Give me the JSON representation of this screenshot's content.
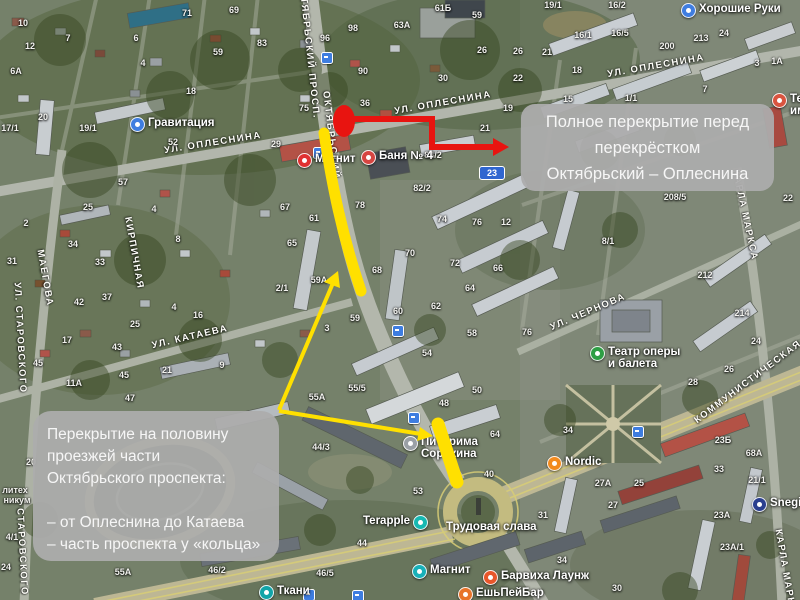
{
  "annotations": {
    "full_closure_note": {
      "lines": [
        "Полное перекрытие перед",
        "перекрёстком",
        "Октябрьский – Оплеснина"
      ]
    },
    "half_closure_note": {
      "lines": [
        "Перекрытие на половину",
        "проезжей части",
        "Октябрьского проспекта:",
        "",
        "– от Оплеснина до Катаева",
        "– часть проспекта у «кольца»"
      ]
    },
    "colors": {
      "marker_red": "#e81410",
      "highlight_yellow": "#ffe000",
      "note_bg": "rgba(172,172,172,0.94)",
      "note_text": "#f6f6f6"
    }
  },
  "map": {
    "street_labels": [
      {
        "text": "Октябрьский просп.",
        "x": 309,
        "y": 50,
        "rot": 84
      },
      {
        "text": "Октябрьский",
        "x": 331,
        "y": 135,
        "rot": 83
      },
      {
        "text": "ул. Оплеснина",
        "x": 213,
        "y": 143,
        "rot": -9
      },
      {
        "text": "ул. Оплеснина",
        "x": 443,
        "y": 103,
        "rot": -10
      },
      {
        "text": "ул. Оплеснина",
        "x": 656,
        "y": 66,
        "rot": -10
      },
      {
        "text": "ул. Катаева",
        "x": 190,
        "y": 337,
        "rot": -13
      },
      {
        "text": "ул. Чернова",
        "x": 588,
        "y": 312,
        "rot": -23
      },
      {
        "text": "Коммунистическая",
        "x": 748,
        "y": 382,
        "rot": -37
      },
      {
        "text": "Карла Маркса",
        "x": 745,
        "y": 215,
        "rot": 78
      },
      {
        "text": "Карла Маркса",
        "x": 786,
        "y": 575,
        "rot": 80
      },
      {
        "text": "ул. Старовского",
        "x": 20,
        "y": 338,
        "rot": 87
      },
      {
        "text": "Старовского",
        "x": 22,
        "y": 552,
        "rot": 87
      },
      {
        "text": "Маегова",
        "x": 45,
        "y": 278,
        "rot": 80
      },
      {
        "text": "Кирпичная",
        "x": 134,
        "y": 253,
        "rot": 80
      }
    ],
    "house_numbers": [
      {
        "n": "10",
        "x": 23,
        "y": 23
      },
      {
        "n": "12",
        "x": 30,
        "y": 46
      },
      {
        "n": "6А",
        "x": 16,
        "y": 71
      },
      {
        "n": "7",
        "x": 68,
        "y": 38
      },
      {
        "n": "6",
        "x": 136,
        "y": 38
      },
      {
        "n": "71",
        "x": 187,
        "y": 13
      },
      {
        "n": "69",
        "x": 234,
        "y": 10
      },
      {
        "n": "83",
        "x": 262,
        "y": 43
      },
      {
        "n": "59",
        "x": 218,
        "y": 52
      },
      {
        "n": "4",
        "x": 143,
        "y": 63
      },
      {
        "n": "18",
        "x": 191,
        "y": 91
      },
      {
        "n": "20",
        "x": 43,
        "y": 117
      },
      {
        "n": "17/1",
        "x": 10,
        "y": 128
      },
      {
        "n": "19/1",
        "x": 88,
        "y": 128
      },
      {
        "n": "52",
        "x": 173,
        "y": 142
      },
      {
        "n": "57",
        "x": 123,
        "y": 182
      },
      {
        "n": "98",
        "x": 353,
        "y": 28
      },
      {
        "n": "96",
        "x": 325,
        "y": 38
      },
      {
        "n": "63А",
        "x": 402,
        "y": 25
      },
      {
        "n": "61Б",
        "x": 443,
        "y": 8
      },
      {
        "n": "59",
        "x": 477,
        "y": 15
      },
      {
        "n": "26",
        "x": 482,
        "y": 50
      },
      {
        "n": "26",
        "x": 518,
        "y": 51
      },
      {
        "n": "90",
        "x": 363,
        "y": 71
      },
      {
        "n": "30",
        "x": 443,
        "y": 78
      },
      {
        "n": "22",
        "x": 518,
        "y": 78
      },
      {
        "n": "36",
        "x": 365,
        "y": 103
      },
      {
        "n": "75",
        "x": 304,
        "y": 108
      },
      {
        "n": "29",
        "x": 276,
        "y": 144
      },
      {
        "n": "19",
        "x": 508,
        "y": 108
      },
      {
        "n": "21",
        "x": 485,
        "y": 128
      },
      {
        "n": "84/2",
        "x": 433,
        "y": 155
      },
      {
        "n": "82/2",
        "x": 422,
        "y": 188
      },
      {
        "n": "19/1",
        "x": 553,
        "y": 5
      },
      {
        "n": "16/2",
        "x": 617,
        "y": 5
      },
      {
        "n": "16/1",
        "x": 583,
        "y": 35
      },
      {
        "n": "16/5",
        "x": 620,
        "y": 33
      },
      {
        "n": "21",
        "x": 547,
        "y": 52
      },
      {
        "n": "18",
        "x": 577,
        "y": 70
      },
      {
        "n": "200",
        "x": 667,
        "y": 46
      },
      {
        "n": "213",
        "x": 701,
        "y": 38
      },
      {
        "n": "24",
        "x": 724,
        "y": 33
      },
      {
        "n": "3",
        "x": 757,
        "y": 63
      },
      {
        "n": "1А",
        "x": 777,
        "y": 61
      },
      {
        "n": "15",
        "x": 568,
        "y": 99
      },
      {
        "n": "1/1",
        "x": 631,
        "y": 98
      },
      {
        "n": "7",
        "x": 705,
        "y": 89
      },
      {
        "n": "208/5",
        "x": 675,
        "y": 197
      },
      {
        "n": "8/1",
        "x": 608,
        "y": 241
      },
      {
        "n": "22",
        "x": 788,
        "y": 198
      },
      {
        "n": "212",
        "x": 705,
        "y": 275
      },
      {
        "n": "214",
        "x": 742,
        "y": 313
      },
      {
        "n": "24",
        "x": 756,
        "y": 341
      },
      {
        "n": "26",
        "x": 729,
        "y": 369
      },
      {
        "n": "28",
        "x": 693,
        "y": 382
      },
      {
        "n": "23Б",
        "x": 723,
        "y": 440
      },
      {
        "n": "34",
        "x": 568,
        "y": 430
      },
      {
        "n": "67",
        "x": 285,
        "y": 207
      },
      {
        "n": "61",
        "x": 314,
        "y": 218
      },
      {
        "n": "65",
        "x": 292,
        "y": 243
      },
      {
        "n": "78",
        "x": 360,
        "y": 205
      },
      {
        "n": "59А",
        "x": 319,
        "y": 280
      },
      {
        "n": "2/1",
        "x": 282,
        "y": 288
      },
      {
        "n": "68",
        "x": 377,
        "y": 270
      },
      {
        "n": "74",
        "x": 442,
        "y": 219
      },
      {
        "n": "76",
        "x": 477,
        "y": 222
      },
      {
        "n": "12",
        "x": 506,
        "y": 222
      },
      {
        "n": "70",
        "x": 410,
        "y": 253
      },
      {
        "n": "72",
        "x": 455,
        "y": 263
      },
      {
        "n": "66",
        "x": 498,
        "y": 268
      },
      {
        "n": "64",
        "x": 470,
        "y": 288
      },
      {
        "n": "62",
        "x": 436,
        "y": 306
      },
      {
        "n": "60",
        "x": 398,
        "y": 311
      },
      {
        "n": "59",
        "x": 355,
        "y": 318
      },
      {
        "n": "3",
        "x": 327,
        "y": 328
      },
      {
        "n": "58",
        "x": 472,
        "y": 333
      },
      {
        "n": "76",
        "x": 527,
        "y": 332
      },
      {
        "n": "54",
        "x": 427,
        "y": 353
      },
      {
        "n": "55/5",
        "x": 357,
        "y": 388
      },
      {
        "n": "55А",
        "x": 317,
        "y": 397
      },
      {
        "n": "44/3",
        "x": 321,
        "y": 447
      },
      {
        "n": "53",
        "x": 418,
        "y": 491
      },
      {
        "n": "48",
        "x": 444,
        "y": 403
      },
      {
        "n": "50",
        "x": 477,
        "y": 390
      },
      {
        "n": "40",
        "x": 489,
        "y": 474
      },
      {
        "n": "64",
        "x": 495,
        "y": 434
      },
      {
        "n": "31",
        "x": 543,
        "y": 515
      },
      {
        "n": "27А",
        "x": 603,
        "y": 483
      },
      {
        "n": "25",
        "x": 639,
        "y": 483
      },
      {
        "n": "27",
        "x": 613,
        "y": 505
      },
      {
        "n": "33",
        "x": 719,
        "y": 469
      },
      {
        "n": "21/1",
        "x": 757,
        "y": 480
      },
      {
        "n": "23А",
        "x": 722,
        "y": 515
      },
      {
        "n": "23А/1",
        "x": 732,
        "y": 547
      },
      {
        "n": "30",
        "x": 617,
        "y": 588
      },
      {
        "n": "34",
        "x": 562,
        "y": 560
      },
      {
        "n": "68А",
        "x": 754,
        "y": 453
      },
      {
        "n": "55А",
        "x": 123,
        "y": 572
      },
      {
        "n": "46/2",
        "x": 217,
        "y": 570
      },
      {
        "n": "46/5",
        "x": 325,
        "y": 573
      },
      {
        "n": "44",
        "x": 362,
        "y": 543
      },
      {
        "n": "25",
        "x": 88,
        "y": 207
      },
      {
        "n": "2",
        "x": 26,
        "y": 223
      },
      {
        "n": "34",
        "x": 73,
        "y": 244
      },
      {
        "n": "31",
        "x": 12,
        "y": 261
      },
      {
        "n": "33",
        "x": 100,
        "y": 262
      },
      {
        "n": "42",
        "x": 79,
        "y": 302
      },
      {
        "n": "37",
        "x": 107,
        "y": 297
      },
      {
        "n": "4",
        "x": 154,
        "y": 209
      },
      {
        "n": "8",
        "x": 178,
        "y": 239
      },
      {
        "n": "4",
        "x": 174,
        "y": 307
      },
      {
        "n": "16",
        "x": 198,
        "y": 315
      },
      {
        "n": "25",
        "x": 135,
        "y": 324
      },
      {
        "n": "17",
        "x": 67,
        "y": 340
      },
      {
        "n": "43",
        "x": 117,
        "y": 347
      },
      {
        "n": "45",
        "x": 38,
        "y": 363
      },
      {
        "n": "45",
        "x": 124,
        "y": 375
      },
      {
        "n": "11А",
        "x": 74,
        "y": 383
      },
      {
        "n": "21",
        "x": 167,
        "y": 370
      },
      {
        "n": "9",
        "x": 222,
        "y": 365
      },
      {
        "n": "47",
        "x": 130,
        "y": 398
      },
      {
        "n": "20",
        "x": 31,
        "y": 462
      },
      {
        "n": "литех",
        "x": 15,
        "y": 490
      },
      {
        "n": "никум",
        "x": 17,
        "y": 500
      },
      {
        "n": "4/1",
        "x": 12,
        "y": 537
      },
      {
        "n": "24",
        "x": 6,
        "y": 567
      }
    ],
    "pois": [
      {
        "lines": [
          "Гравитация"
        ],
        "x": 130,
        "y": 117,
        "color": "#3f7de0",
        "icon": "fitness-club"
      },
      {
        "lines": [
          "Магнит"
        ],
        "x": 297,
        "y": 153,
        "color": "#e03131",
        "icon": "supermarket"
      },
      {
        "lines": [
          "Баня № 4"
        ],
        "x": 361,
        "y": 150,
        "color": "#d64541",
        "icon": "bathhouse"
      },
      {
        "lines": [
          "Хорошие Руки"
        ],
        "x": 681,
        "y": 3,
        "color": "#3f7de0",
        "icon": "service"
      },
      {
        "lines": [
          "Театр оперы",
          "и балета"
        ],
        "x": 590,
        "y": 346,
        "color": "#2e9e44",
        "icon": "theatre"
      },
      {
        "lines": [
          "Питирима",
          "Сорокина"
        ],
        "x": 403,
        "y": 436,
        "color": "#9aa0a6",
        "icon": "organization"
      },
      {
        "lines": [
          "Nordic"
        ],
        "x": 547,
        "y": 456,
        "color": "#f28b1e",
        "icon": "fitness-club"
      },
      {
        "lines": [
          "Snegir"
        ],
        "x": 752,
        "y": 497,
        "color": "#2b3f8f",
        "icon": "shop"
      },
      {
        "lines": [
          "Ткани"
        ],
        "x": 259,
        "y": 585,
        "color": "#12a4a8",
        "icon": "shop"
      },
      {
        "lines": [
          "Магнит"
        ],
        "x": 412,
        "y": 564,
        "color": "#18b0b8",
        "icon": "supermarket"
      },
      {
        "lines": [
          "Барвиха Лаунж"
        ],
        "x": 483,
        "y": 570,
        "color": "#e8562a",
        "icon": "cafe"
      },
      {
        "lines": [
          "ЕшьПейБар"
        ],
        "x": 458,
        "y": 587,
        "color": "#e8742a",
        "icon": "cafe"
      },
      {
        "lines": [
          "Terapple"
        ],
        "x": 363,
        "y": 515,
        "color": "#16b8b2",
        "icon": "shop",
        "icon_after": true
      },
      {
        "lines": [
          "Трудовая слава"
        ],
        "x": 446,
        "y": 521,
        "color": null,
        "icon": null
      },
      {
        "lines": [
          "Театр",
          "им. В"
        ],
        "x": 772,
        "y": 93,
        "color": "#d9543f",
        "icon": "theatre"
      }
    ],
    "transit_stops": [
      {
        "x": 326,
        "y": 57
      },
      {
        "x": 318,
        "y": 152
      },
      {
        "x": 397,
        "y": 330
      },
      {
        "x": 413,
        "y": 417
      },
      {
        "x": 308,
        "y": 594
      },
      {
        "x": 357,
        "y": 595
      },
      {
        "x": 637,
        "y": 431
      }
    ],
    "route_signs": [
      {
        "text": "23",
        "x": 492,
        "y": 173
      }
    ]
  }
}
